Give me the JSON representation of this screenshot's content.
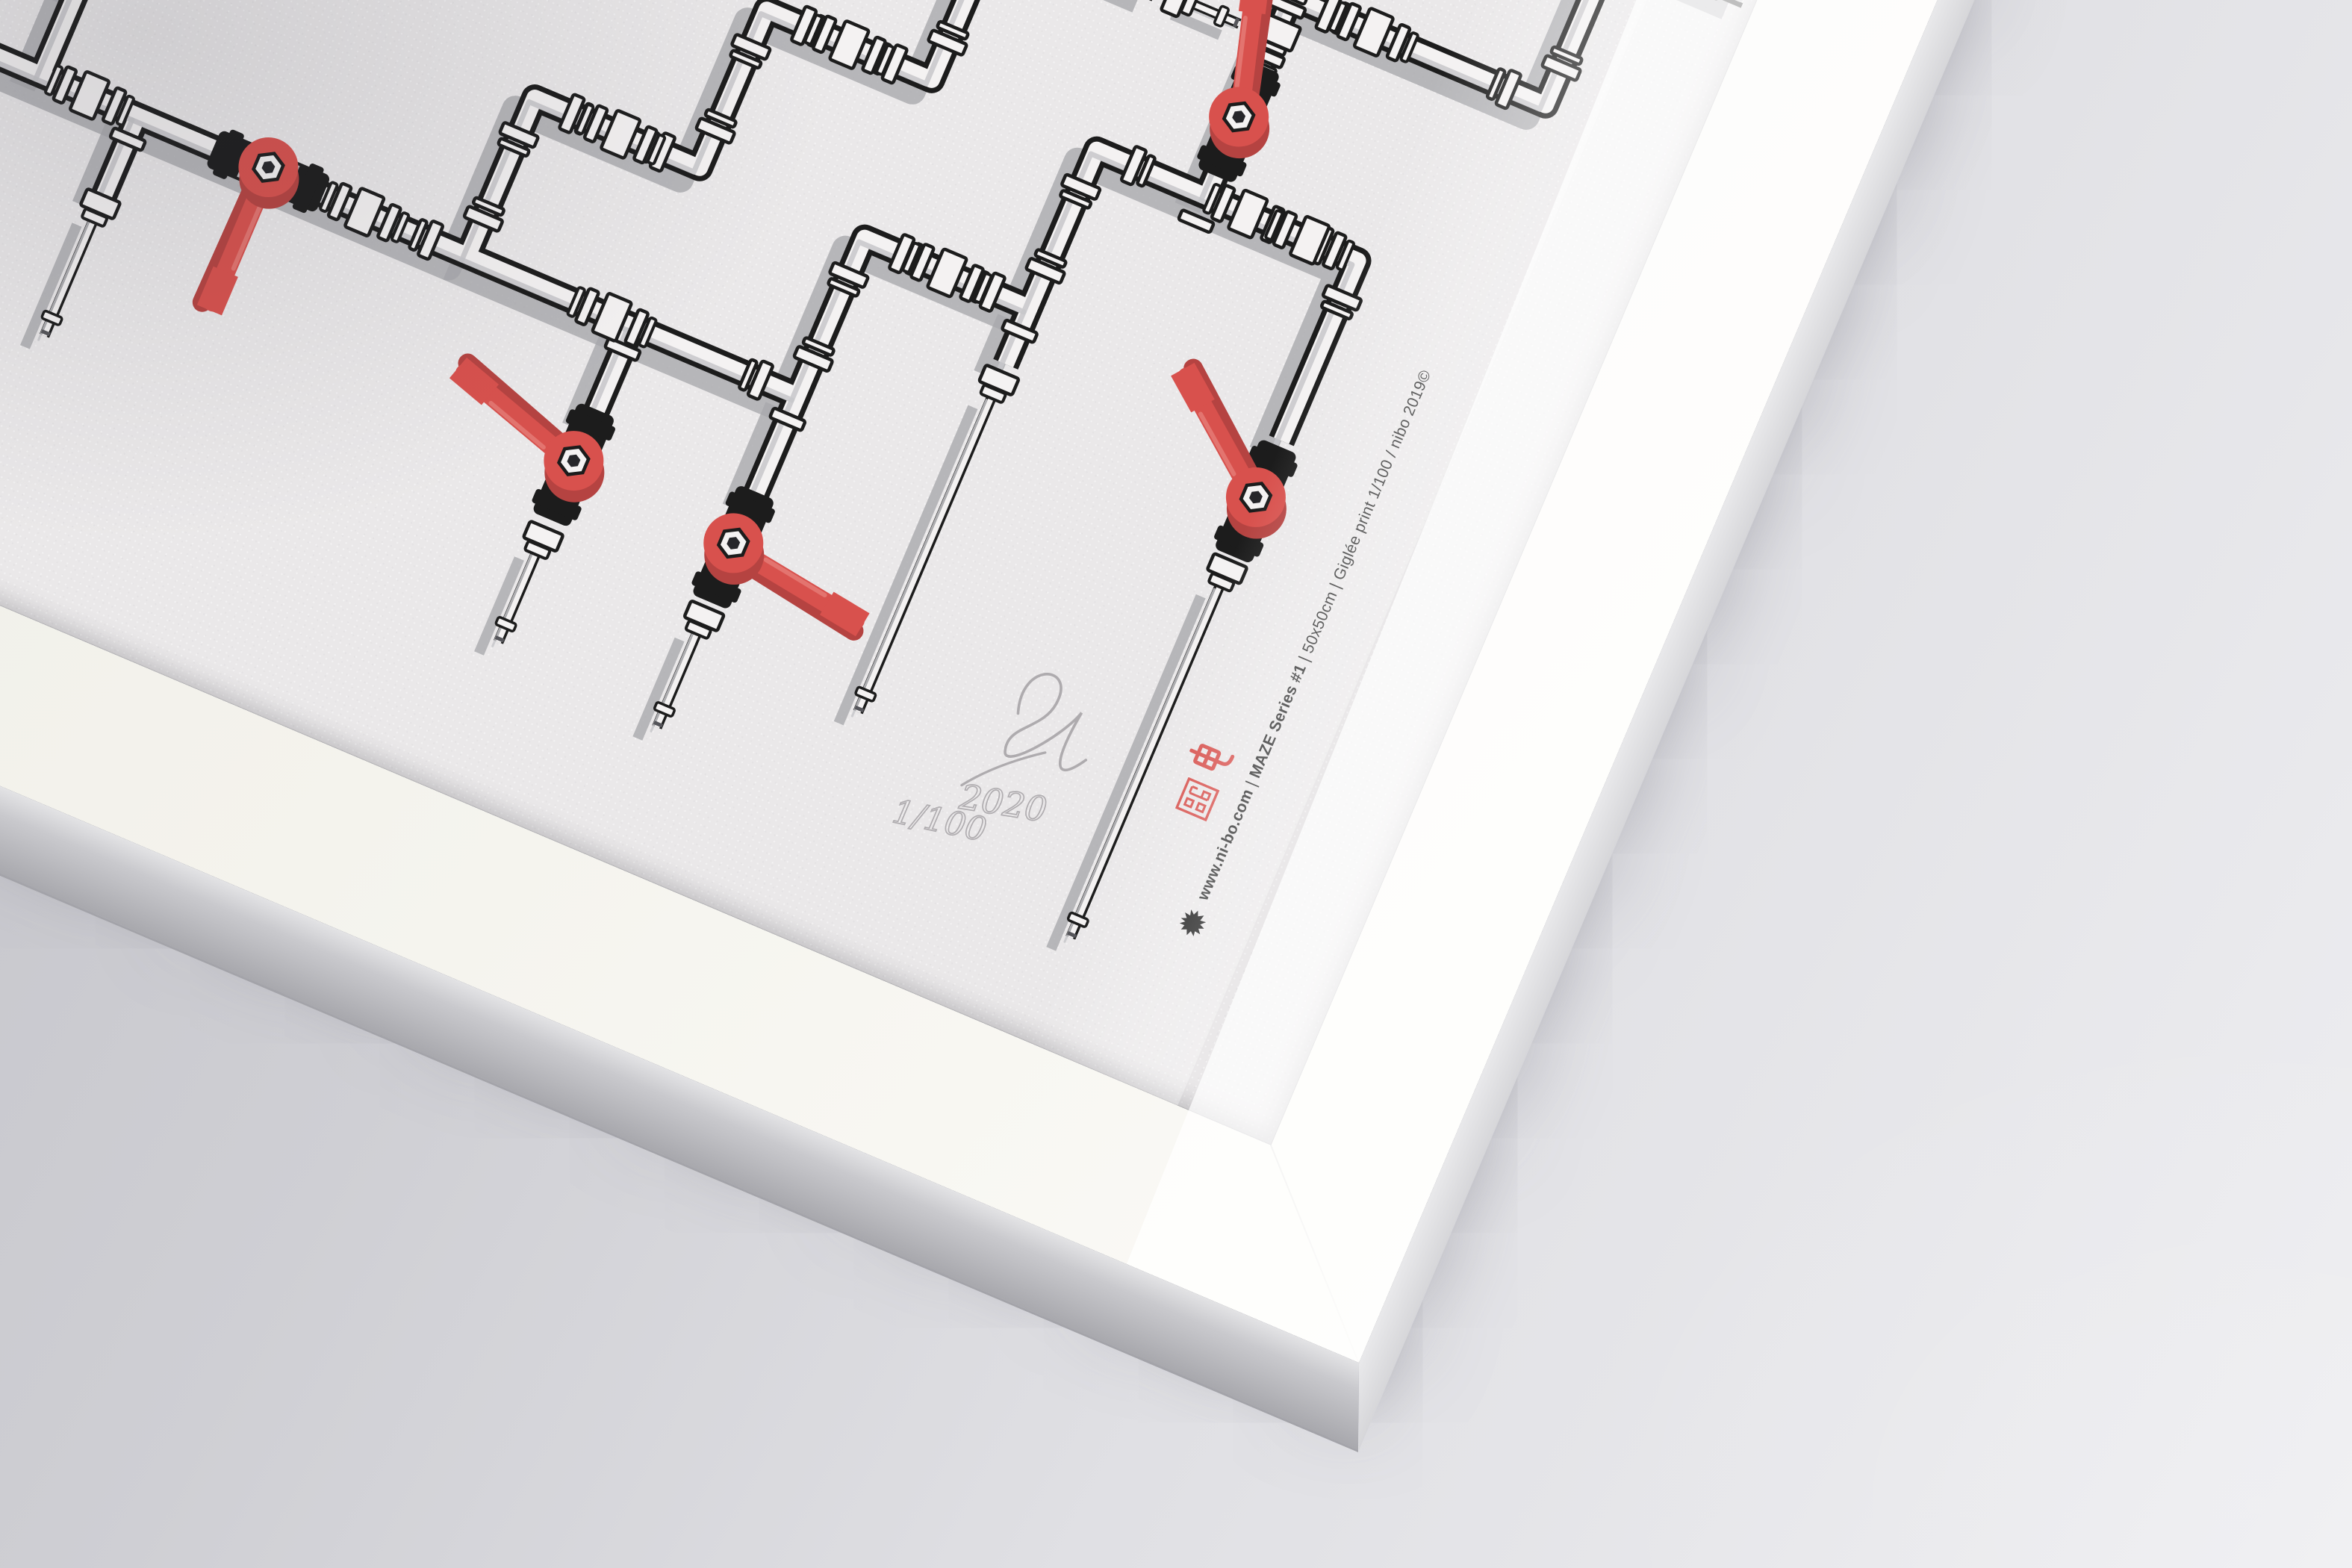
{
  "scene": {
    "background_top_left": "#c3c3c9",
    "background_bottom_right": "#eeeef1",
    "frame_color": "#f4f3ed",
    "frame_rotation_deg": 23,
    "paper_color": "#eae8e9"
  },
  "caption": {
    "color": "#2b2b2b",
    "bullet_icon": "starburst",
    "segments": [
      {
        "text": "www.ni-bo.com",
        "weight": 700
      },
      {
        "text": "  |  ",
        "weight": 400
      },
      {
        "text": "MAZE",
        "weight": 700
      },
      {
        "text": " Series #1",
        "weight": 700
      },
      {
        "text": "  |  ",
        "weight": 400
      },
      {
        "text": "50x50cm",
        "weight": 400
      },
      {
        "text": "  |  ",
        "weight": 400
      },
      {
        "text": "Giglée print 1/100 / nibo 2019©",
        "weight": 400
      }
    ],
    "logos": [
      "nibo-seal",
      "den-glyph"
    ],
    "logo_color": "#d85450"
  },
  "signature": {
    "year": "2020",
    "edition": "1/100",
    "pencil_color": "#aeabae"
  },
  "artwork": {
    "title": "MAZE Series #1 pipe maze illustration",
    "colors": {
      "ink": "#1c1c1c",
      "pipe": "#f4f2f2",
      "shade": "#c7c7ca",
      "cast": "#a9a9ad",
      "red": "#d8514d",
      "red_dark": "#b54341",
      "red_hi": "#e8837d",
      "facet": "#bfbfc3",
      "plug": "#55555a"
    },
    "pipes": [
      {
        "kind": "main",
        "pts": [
          [
            -80,
            1630
          ],
          [
            850,
            1630
          ],
          [
            850,
            1400
          ],
          [
            1090,
            1400
          ],
          [
            1090,
            1170
          ],
          [
            1330,
            1170
          ],
          [
            1330,
            940
          ],
          [
            1560,
            940
          ]
        ]
      },
      {
        "kind": "main",
        "pts": [
          [
            850,
            1630
          ],
          [
            1330,
            1630
          ],
          [
            1330,
            1400
          ],
          [
            1570,
            1400
          ],
          [
            1570,
            1170
          ],
          [
            1950,
            1170
          ],
          [
            1950,
            1432
          ]
        ]
      },
      {
        "kind": "main",
        "pts": [
          [
            1730,
            1170
          ],
          [
            1730,
            880
          ],
          [
            2100,
            880
          ],
          [
            2100,
            640
          ],
          [
            2290,
            640
          ]
        ]
      },
      {
        "kind": "main",
        "pts": [
          [
            2290,
            230
          ],
          [
            1950,
            230
          ],
          [
            1950,
            470
          ],
          [
            2290,
            470
          ]
        ]
      },
      {
        "kind": "main",
        "pts": [
          [
            -80,
            1490
          ],
          [
            230,
            1490
          ],
          [
            230,
            1345
          ],
          [
            -80,
            1345
          ]
        ]
      },
      {
        "kind": "main",
        "pts": [
          [
            230,
            1630
          ],
          [
            230,
            1490
          ]
        ]
      },
      {
        "kind": "main",
        "pts": [
          [
            130,
            1630
          ],
          [
            130,
            1795
          ]
        ]
      },
      {
        "kind": "main",
        "pts": [
          [
            370,
            1630
          ],
          [
            370,
            1745
          ]
        ]
      },
      {
        "kind": "main",
        "pts": [
          [
            1090,
            1630
          ],
          [
            1090,
            1762
          ]
        ]
      },
      {
        "kind": "main",
        "pts": [
          [
            1330,
            1630
          ],
          [
            1330,
            1778
          ]
        ]
      },
      {
        "kind": "main",
        "pts": [
          [
            1570,
            1400
          ],
          [
            1570,
            1482
          ]
        ]
      },
      {
        "kind": "thin",
        "pts": [
          [
            130,
            1822
          ],
          [
            130,
            2000
          ]
        ]
      },
      {
        "kind": "thin",
        "pts": [
          [
            370,
            1772
          ],
          [
            370,
            1950
          ]
        ]
      },
      {
        "kind": "thin",
        "pts": [
          [
            1090,
            1952
          ],
          [
            1090,
            2090
          ]
        ]
      },
      {
        "kind": "thin",
        "pts": [
          [
            1330,
            1968
          ],
          [
            1330,
            2112
          ]
        ]
      },
      {
        "kind": "thin",
        "pts": [
          [
            1570,
            1528
          ],
          [
            1570,
            1988
          ]
        ]
      },
      {
        "kind": "thin",
        "pts": [
          [
            1950,
            1642
          ],
          [
            1950,
            2155
          ]
        ]
      },
      {
        "kind": "thin",
        "pts": [
          [
            1610,
            940
          ],
          [
            1680,
            940
          ]
        ]
      }
    ],
    "unions": [
      [
        300,
        1630,
        0
      ],
      [
        700,
        1630,
        0
      ],
      [
        975,
        1400,
        0
      ],
      [
        1210,
        1170,
        0
      ],
      [
        1455,
        940,
        0
      ],
      [
        1060,
        1630,
        0
      ],
      [
        1450,
        1400,
        0
      ],
      [
        1790,
        1170,
        0
      ],
      [
        1880,
        1170,
        0
      ],
      [
        1850,
        880,
        0
      ],
      [
        2200,
        640,
        0
      ],
      [
        2060,
        230,
        0
      ],
      [
        2230,
        470,
        0
      ],
      [
        1730,
        930,
        90
      ]
    ],
    "reducers": [
      [
        130,
        1808,
        90
      ],
      [
        370,
        1758,
        90
      ],
      [
        1090,
        1936,
        90
      ],
      [
        1330,
        1950,
        90
      ],
      [
        1570,
        1505,
        90
      ],
      [
        1950,
        1618,
        90
      ],
      [
        1588,
        940,
        0
      ]
    ],
    "tcollars": [
      [
        130,
        1664
      ],
      [
        370,
        1664
      ],
      [
        1090,
        1664
      ],
      [
        1330,
        1664
      ],
      [
        1570,
        1434
      ],
      [
        1730,
        1206
      ]
    ],
    "caps": [
      [
        130,
        2000,
        90
      ],
      [
        370,
        1950,
        90
      ],
      [
        1090,
        2090,
        90
      ],
      [
        1330,
        2112,
        90
      ],
      [
        1570,
        1988,
        90
      ],
      [
        1950,
        2155,
        90
      ],
      [
        1680,
        940,
        0
      ]
    ],
    "valves": [
      [
        560,
        1630,
        0,
        90
      ],
      [
        1730,
        1060,
        90,
        -106
      ],
      [
        1950,
        1520,
        90,
        -142
      ],
      [
        1090,
        1832,
        90,
        197
      ],
      [
        1330,
        1850,
        90,
        8
      ],
      [
        2120,
        470,
        0,
        -90
      ]
    ]
  }
}
